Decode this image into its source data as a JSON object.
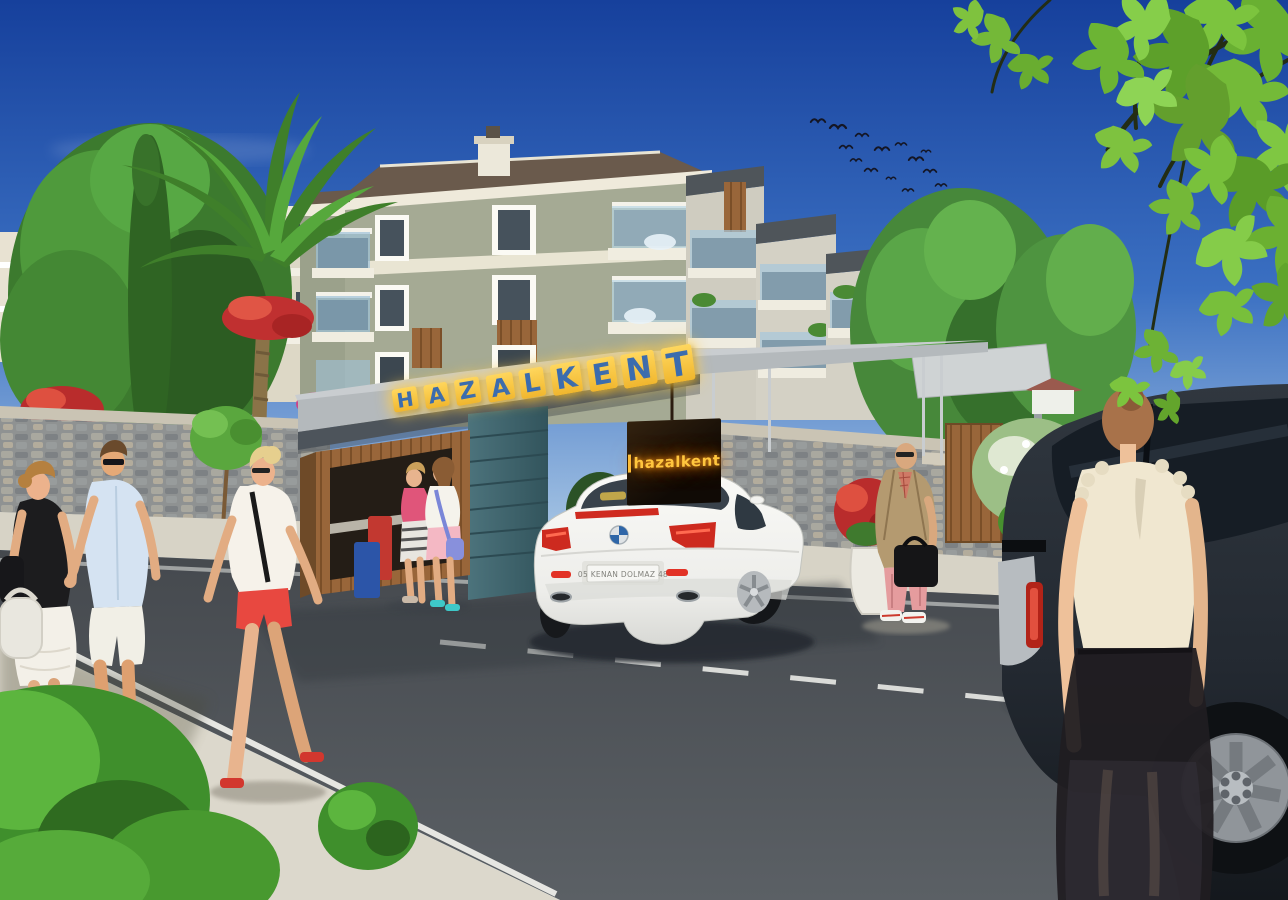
{
  "signs": {
    "main": {
      "text": "HAZALKENT",
      "letters": [
        "H",
        "A",
        "Z",
        "A",
        "L",
        "K",
        "E",
        "N",
        "T"
      ],
      "letter_color": "#3b6cae",
      "block_color": "#f5c437"
    },
    "entrance_panel": {
      "text": "hazalkent",
      "glow_color": "#ffc63e"
    },
    "license_plate": {
      "text": "05 KENAN DOLMAZ 48"
    }
  },
  "palette": {
    "sky_top": "#16409c",
    "sky_horizon": "#b9d4ea",
    "facade_sage": "#a5aa94",
    "trim_cream": "#ece8d8",
    "canopy_gray": "#b4b9bc",
    "pillar_teal": "#47707a",
    "wood_brown": "#8a5c34",
    "road_asphalt": "#50555a",
    "sidewalk": "#d9d5c9",
    "leaf_green": "#74bc3a",
    "taillight_red": "#d0281e"
  },
  "scene": {
    "sky": "clear blue sky with a small flock of birds",
    "buildings": "three-storey apartment blocks with balconies and wood accents",
    "entrance": "HAZALKENT gated entrance canopy with wooden booth and teal pillar",
    "vehicles": [
      "white coupe at the gate",
      "dark SUV parked at right curb"
    ],
    "people": [
      "couple holding hands",
      "woman in red shorts",
      "two women at the gate booth",
      "bald man with briefcase",
      "woman beside the SUV"
    ]
  }
}
